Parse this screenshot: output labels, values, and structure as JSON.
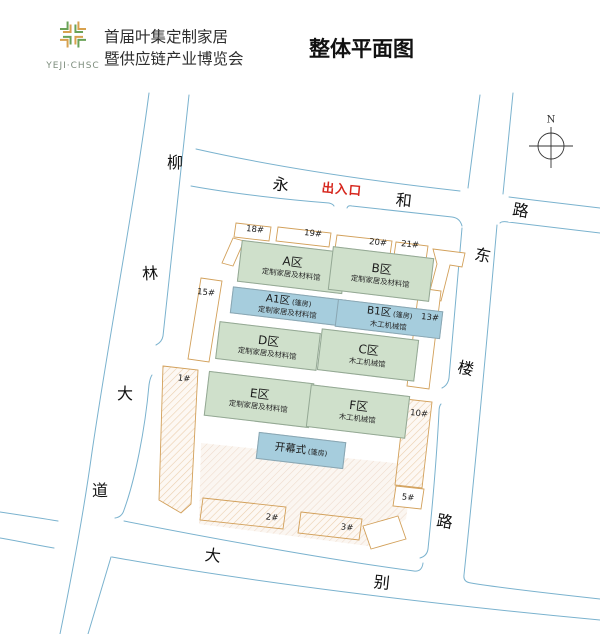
{
  "header": {
    "logo_text": "YEJI·CHSC",
    "title_line1": "首届叶集定制家居",
    "title_line2": "暨供应链产业博览会",
    "main_title": "整体平面图"
  },
  "compass": {
    "north_label": "N"
  },
  "map": {
    "entrance_label": "出入口",
    "roads": {
      "liu": "柳",
      "lin": "林",
      "da_left": "大",
      "dao": "道",
      "yong": "永",
      "he": "和",
      "lu_top": "路",
      "dong": "东",
      "lou": "楼",
      "lu_right": "路",
      "da_bottom": "大",
      "bie": "别"
    },
    "halls": {
      "a": {
        "name": "A区",
        "sub": "定制家居及材料馆"
      },
      "b": {
        "name": "B区",
        "sub": "定制家居及材料馆"
      },
      "a1": {
        "name": "A1区",
        "tag": "(篷房)",
        "sub": "定制家居及材料馆"
      },
      "b1": {
        "name": "B1区",
        "tag": "(篷房)",
        "sub": "木工机械馆"
      },
      "d": {
        "name": "D区",
        "sub": "定制家居及材料馆"
      },
      "c": {
        "name": "C区",
        "sub": "木工机械馆"
      },
      "e": {
        "name": "E区",
        "sub": "定制家居及材料馆"
      },
      "f": {
        "name": "F区",
        "sub": "木工机械馆"
      },
      "opening": {
        "name": "开幕式",
        "tag": "(篷房)"
      }
    },
    "buildings": {
      "b1": "1#",
      "b2": "2#",
      "b3": "3#",
      "b5": "5#",
      "b10": "10#",
      "b13": "13#",
      "b15": "15#",
      "b18": "18#",
      "b19": "19#",
      "b20": "20#",
      "b21": "21#"
    }
  },
  "colors": {
    "hall_green": "#cfe0cb",
    "hall_blue": "#a6cddd",
    "road_blue": "#7ab2ce",
    "outline_orange": "#d2a05a",
    "gate_red": "#d6251c",
    "logo_green": "#6aa257",
    "logo_orange": "#d8a14e"
  }
}
